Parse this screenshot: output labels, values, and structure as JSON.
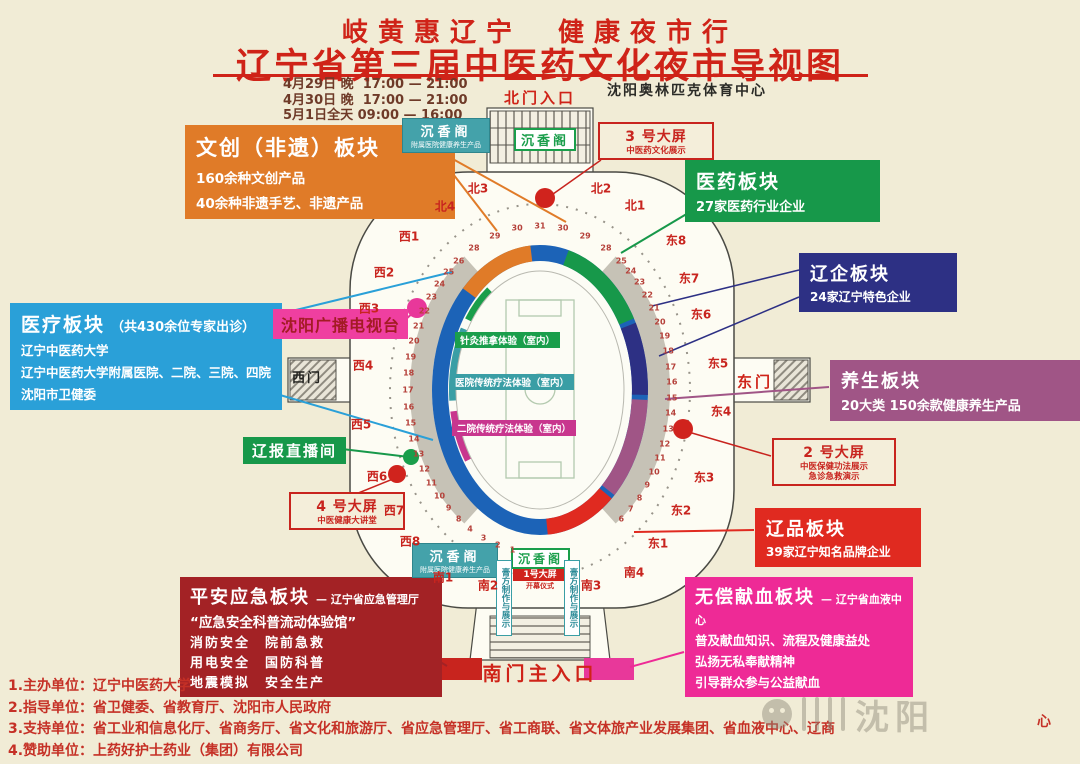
{
  "header": {
    "subtitle": "岐黄惠辽宁　健康夜市行",
    "title": "辽宁省第三届中医药文化夜市导视图",
    "schedule": "4月29日 晚  17:00 — 21:00\n4月30日 晚  17:00 — 21:00\n5月1日全天 09:00 — 16:00",
    "venue": "沈阳奥林匹克体育中心"
  },
  "entrances": {
    "north": "北门入口",
    "south": "南门主入口",
    "west": "西门",
    "east": "东门"
  },
  "callouts": {
    "wenchuang": {
      "title": "文创（非遗）板块",
      "lines": [
        "160余种文创产品",
        "40余种非遗手艺、非遗产品"
      ]
    },
    "yiyao": {
      "title": "医药板块",
      "lines": [
        "27家医药行业企业"
      ]
    },
    "liaoqi": {
      "title": "辽企板块",
      "lines": [
        "24家辽宁特色企业"
      ]
    },
    "yiliao": {
      "title": "医疗板块",
      "suffix": "（共430余位专家出诊）",
      "lines": [
        "辽宁中医药大学",
        "辽宁中医药大学附属医院、二院、三院、四院",
        "沈阳市卫健委"
      ]
    },
    "tv": {
      "title": "沈阳广播电视台"
    },
    "yangsheng": {
      "title": "养生板块",
      "lines": [
        "20大类 150余款健康养生产品"
      ]
    },
    "liaobao": {
      "title": "辽报直播间"
    },
    "liaopin": {
      "title": "辽品板块",
      "lines": [
        "39家辽宁知名品牌企业"
      ]
    },
    "pingan": {
      "title": "平安应急板块",
      "suffix": "— 辽宁省应急管理厅",
      "subtitle": "“应急安全科普流动体验馆”",
      "lines": [
        "消防安全　院前急救",
        "用电安全　国防科普",
        "地震模拟　安全生产"
      ]
    },
    "xianxue": {
      "title": "无偿献血板块",
      "suffix": "— 辽宁省血液中心",
      "lines": [
        "普及献血知识、流程及健康益处",
        "弘扬无私奉献精神",
        "引导群众参与公益献血"
      ]
    }
  },
  "screens": {
    "s1": {
      "title": "1号大屏",
      "sub": "开幕仪式"
    },
    "s2": {
      "title": "2 号大屏",
      "sub1": "中医保健功法展示",
      "sub2": "急诊急救演示"
    },
    "s3": {
      "title": "3 号大屏",
      "sub1": "中医药文化展示"
    },
    "s4": {
      "title": "4 号大屏",
      "sub1": "中医健康大讲堂"
    }
  },
  "pavilions": {
    "chenxiang_title": "沉香阁",
    "chenxiang_sub": "附属医院健康养生产品",
    "gaofang_strip": "膏方制作与展示"
  },
  "indoor": [
    "针灸推拿体验（室内）",
    "医院传统疗法体验（室内）",
    "二院传统疗法体验（室内）"
  ],
  "gates": [
    "北4",
    "北3",
    "北2",
    "北1",
    "西1",
    "西2",
    "西3",
    "西4",
    "西5",
    "西6",
    "西7",
    "西8",
    "东8",
    "东7",
    "东6",
    "东5",
    "东4",
    "东3",
    "东2",
    "东1",
    "南1",
    "南2",
    "南3",
    "南4"
  ],
  "map": {
    "booth_numbers": {
      "west": [
        "26",
        "25",
        "24",
        "23",
        "22",
        "21",
        "20",
        "19",
        "18",
        "17",
        "16",
        "15",
        "14",
        "13",
        "12",
        "11",
        "10",
        "9",
        "8"
      ],
      "east": [
        "25",
        "24",
        "23",
        "22",
        "21",
        "20",
        "19",
        "18",
        "17",
        "16",
        "15",
        "14",
        "13",
        "12",
        "11",
        "10",
        "9",
        "8",
        "7",
        "6"
      ],
      "north": [
        "28",
        "29",
        "30",
        "31",
        "30",
        "29",
        "28"
      ],
      "south": [
        "4",
        "3",
        "2",
        "1"
      ]
    }
  },
  "footer": {
    "line1": "1.主办单位：辽宁中医药大学",
    "line2": "2.指导单位：省卫健委、省教育厅、沈阳市人民政府",
    "line3": "3.支持单位：省工业和信息化厅、省商务厅、省文化和旅游厅、省应急管理厅、省工商联、省文体旅产业发展集团、省血液中心、辽商",
    "line3_tail": "心",
    "line4": "4.赞助单位：上药好护士药业（集团）有限公司"
  },
  "watermark": {
    "text": "沈阳"
  },
  "colors": {
    "background": "#f1ecd6",
    "title_red": "#cf2318",
    "wenchuang_orange": "#e07b28",
    "yiyao_green": "#17984a",
    "liaoqi_navy": "#2d3084",
    "yiliao_blue": "#2aa0d8",
    "tv_magenta": "#ef3fa0",
    "yangsheng_mauve": "#a05586",
    "liaopin_red": "#e02a20",
    "pingan_darkred": "#a32225",
    "xianxue_pink": "#ee2a96",
    "pavilion_teal": "#44a2aa",
    "track_blue": "#1c63b7"
  }
}
